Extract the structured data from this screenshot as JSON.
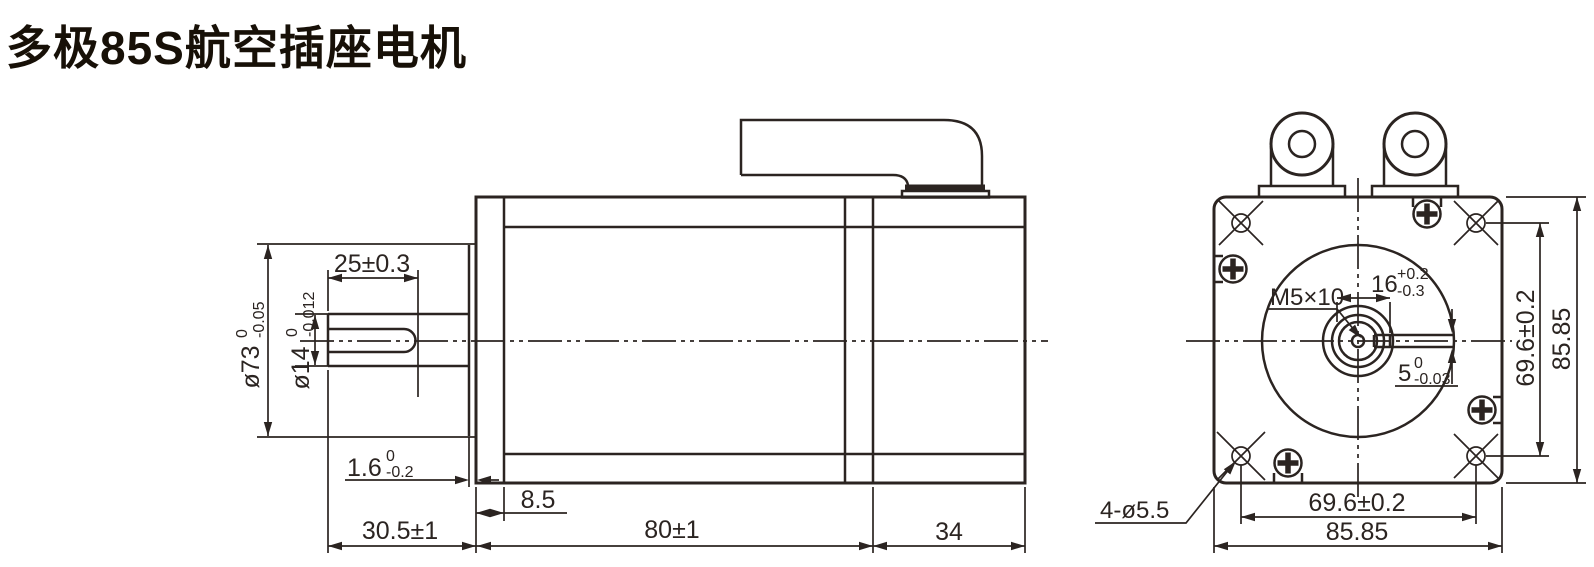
{
  "title": "多极85S航空插座电机",
  "colors": {
    "line": "#2b2421",
    "title": "#171007",
    "background": "#ffffff"
  },
  "side_view": {
    "dims": {
      "shaft_key_len": "25±0.3",
      "pilot_dia": {
        "v": "ø73",
        "up": "0",
        "dn": "-0.05"
      },
      "shaft_dia": {
        "v": "ø14",
        "up": "0",
        "dn": "-0.012"
      },
      "pilot_depth": {
        "v": "1.6",
        "up": "0",
        "dn": "-0.2"
      },
      "flange_thickness": "8.5",
      "shaft_extension": "30.5±1",
      "body_length": "80±1",
      "rear_length": "34"
    }
  },
  "front_view": {
    "dims": {
      "tapped_hole": "M5×10",
      "key_offset": {
        "v": "16",
        "up": "+0.2",
        "dn": "-0.3"
      },
      "key_width": {
        "v": "5",
        "up": "0",
        "dn": "-0.03"
      },
      "mount_holes_note": "4-ø5.5",
      "hole_pitch_h": "69.6±0.2",
      "frame_width": "85.85",
      "hole_pitch_v": "69.6±0.2",
      "frame_height": "85.85"
    }
  }
}
